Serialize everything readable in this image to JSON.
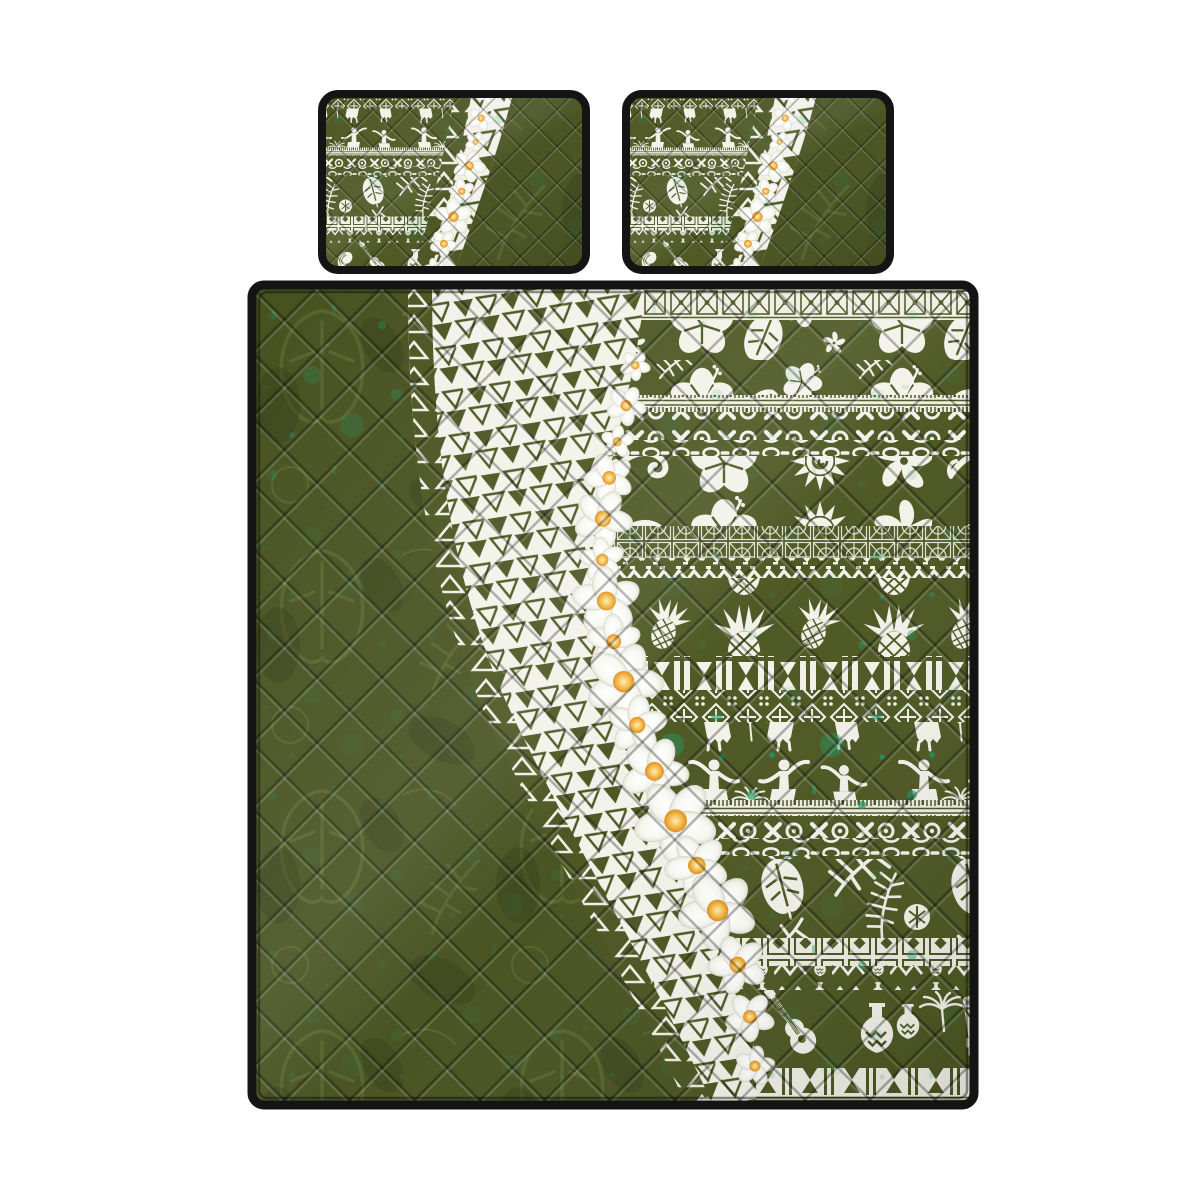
{
  "scene": {
    "description_name": "hawaiian-polynesian-quilt-bed-set-product-photo",
    "background_color": "#ffffff"
  },
  "colors": {
    "olive_base": "#47511f",
    "olive_band_bg": "#4c5621",
    "olive_line": "#4a5420",
    "olive_leaf_light": "#66743a",
    "olive_dark": "#2e3812",
    "ivory_print": "#f2f2e9",
    "teal_grunge": "#1c9663",
    "piping_black": "#141414",
    "plumeria_center_deep": "#df8c1a",
    "plumeria_center_mid": "#f5bc4e",
    "plumeria_center_pale": "#fdeeb0"
  },
  "pillows": {
    "count": 2,
    "items": [
      {
        "name": "pillow-sham-left"
      },
      {
        "name": "pillow-sham-right"
      }
    ]
  },
  "quilt": {
    "name": "quilt-cover",
    "bands": [
      {
        "name": "tapa-tile-border",
        "pattern": "tileX",
        "y": 0,
        "h": 35
      },
      {
        "name": "hibiscus-foliage",
        "pattern": "hibiscus",
        "y": 35,
        "h": 75
      },
      {
        "name": "comb-border",
        "pattern": "comb",
        "y": 110,
        "h": 17
      },
      {
        "name": "x-and-circle",
        "pattern": "xo",
        "y": 127,
        "h": 28
      },
      {
        "name": "chain",
        "pattern": "chain",
        "y": 155,
        "h": 16
      },
      {
        "name": "island-motifs",
        "pattern": "motifRow",
        "y": 171,
        "h": 70
      },
      {
        "name": "lace-tiles",
        "pattern": "denseTile",
        "y": 241,
        "h": 32
      },
      {
        "name": "zigzag-blocks",
        "pattern": "zigzag",
        "y": 273,
        "h": 20
      },
      {
        "name": "pineapples",
        "pattern": "pineapple",
        "y": 293,
        "h": 78
      },
      {
        "name": "bars-hourglass",
        "pattern": "bars",
        "y": 371,
        "h": 34
      },
      {
        "name": "flower-tiles",
        "pattern": "flowerTile",
        "y": 405,
        "h": 32
      },
      {
        "name": "hula-dancers",
        "pattern": "dancers",
        "y": 437,
        "h": 78
      },
      {
        "name": "comb-border-2",
        "pattern": "comb",
        "y": 515,
        "h": 16
      },
      {
        "name": "x-and-circle-2",
        "pattern": "xo",
        "y": 531,
        "h": 22
      },
      {
        "name": "chain-2",
        "pattern": "chain",
        "y": 553,
        "h": 18
      },
      {
        "name": "palm-leaves",
        "pattern": "palms",
        "y": 571,
        "h": 82
      },
      {
        "name": "square-tiles",
        "pattern": "sqTile",
        "y": 653,
        "h": 28
      },
      {
        "name": "zigzag-vessels",
        "pattern": "zigVessel",
        "y": 681,
        "h": 24
      },
      {
        "name": "instruments",
        "pattern": "instruments",
        "y": 705,
        "h": 78
      },
      {
        "name": "sawtooth-border",
        "pattern": "bottomX",
        "y": 783,
        "h": 37
      }
    ],
    "motifs": [
      "hibiscus",
      "monstera-leaf",
      "palm-frond",
      "plumeria",
      "sun-spiral",
      "koru-wave",
      "pineapple",
      "hula-dancer",
      "chain-link",
      "tapa-geometric",
      "ukulele",
      "pahu-drum",
      "ipu-gourd",
      "vase",
      "conch-shell"
    ]
  },
  "leis": [
    {
      "name": "quilt-plumeria-lei",
      "path": "leiPath",
      "group": "leiFlowers",
      "flowers": [
        {
          "t": 0.08,
          "s": 13,
          "r": 10
        },
        {
          "t": 0.13,
          "s": 17,
          "r": 80
        },
        {
          "t": 0.175,
          "s": 14,
          "r": 200
        },
        {
          "t": 0.22,
          "s": 21,
          "r": 30
        },
        {
          "t": 0.27,
          "s": 25,
          "r": 150
        },
        {
          "t": 0.32,
          "s": 19,
          "r": 260
        },
        {
          "t": 0.37,
          "s": 29,
          "r": 45
        },
        {
          "t": 0.42,
          "s": 23,
          "r": 120
        },
        {
          "t": 0.47,
          "s": 33,
          "r": 0
        },
        {
          "t": 0.525,
          "s": 25,
          "r": 200
        },
        {
          "t": 0.585,
          "s": 29,
          "r": 75
        },
        {
          "t": 0.65,
          "s": 35,
          "r": 160
        },
        {
          "t": 0.71,
          "s": 27,
          "r": 310
        },
        {
          "t": 0.77,
          "s": 33,
          "r": 20
        },
        {
          "t": 0.84,
          "s": 25,
          "r": 100
        },
        {
          "t": 0.905,
          "s": 21,
          "r": 230
        },
        {
          "t": 0.965,
          "s": 17,
          "r": 60
        }
      ]
    },
    {
      "name": "pillow-plumeria-lei",
      "path": "pLei",
      "group": "pLeiFlowers",
      "flowers": [
        {
          "t": 0.05,
          "s": 8,
          "r": 0
        },
        {
          "t": 0.17,
          "s": 11,
          "r": 70
        },
        {
          "t": 0.29,
          "s": 9,
          "r": 150
        },
        {
          "t": 0.41,
          "s": 14,
          "r": 220
        },
        {
          "t": 0.54,
          "s": 11,
          "r": 40
        },
        {
          "t": 0.67,
          "s": 16,
          "r": 120
        },
        {
          "t": 0.81,
          "s": 12,
          "r": 300
        },
        {
          "t": 0.94,
          "s": 9,
          "r": 180
        }
      ]
    }
  ]
}
